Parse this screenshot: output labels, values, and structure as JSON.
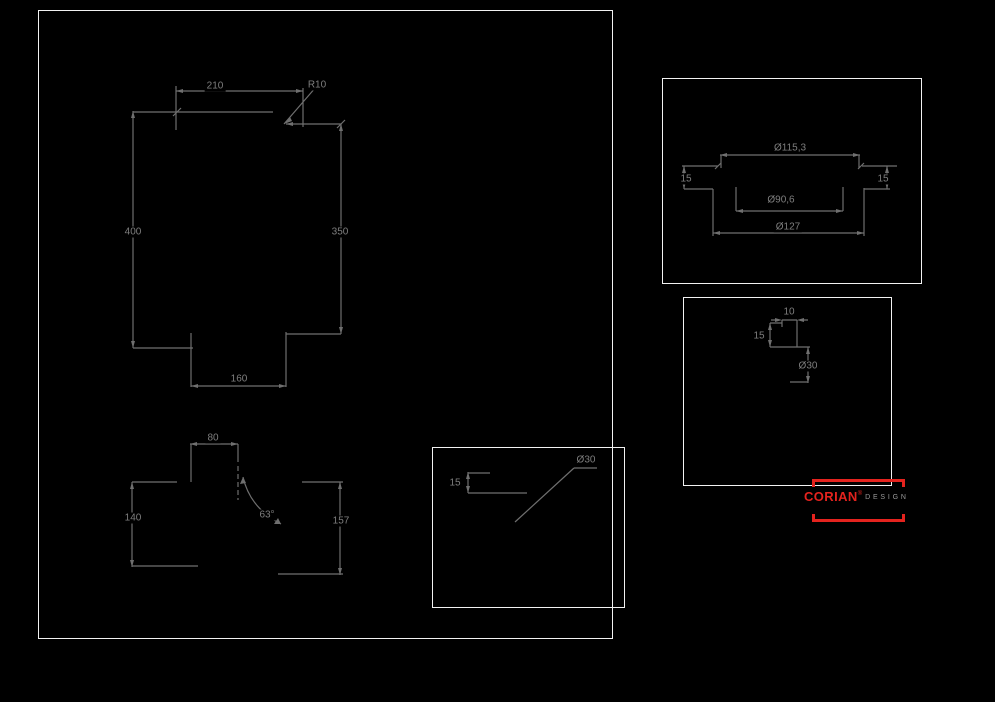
{
  "colors": {
    "background": "#000000",
    "frame_border": "#f2f2f2",
    "dimension_line": "#6f6f6f",
    "dimension_text": "#7e7e7e",
    "brand_red": "#e4231e",
    "logo_suffix_gray": "#9a9a9a"
  },
  "main_view": {
    "width_top": "210",
    "corner_radius": "R10",
    "height_left": "400",
    "height_right": "350",
    "width_bottom": "160"
  },
  "side_view": {
    "width_top": "80",
    "height_left": "140",
    "height_right": "157",
    "angle": "63°"
  },
  "section_view": {
    "top_diameter": "Ø115,3",
    "rim_height_left": "15",
    "rim_height_right": "15",
    "inner_diameter": "Ø90,6",
    "outer_diameter": "Ø127"
  },
  "drain_detail": {
    "offset_width": "10",
    "offset_depth": "15",
    "hole_diameter": "Ø30"
  },
  "hole_detail": {
    "edge_distance": "15",
    "hole_diameter": "Ø30"
  },
  "logo": {
    "brand": "CORIAN",
    "registered_mark": "®",
    "suffix": "DESIGN"
  }
}
